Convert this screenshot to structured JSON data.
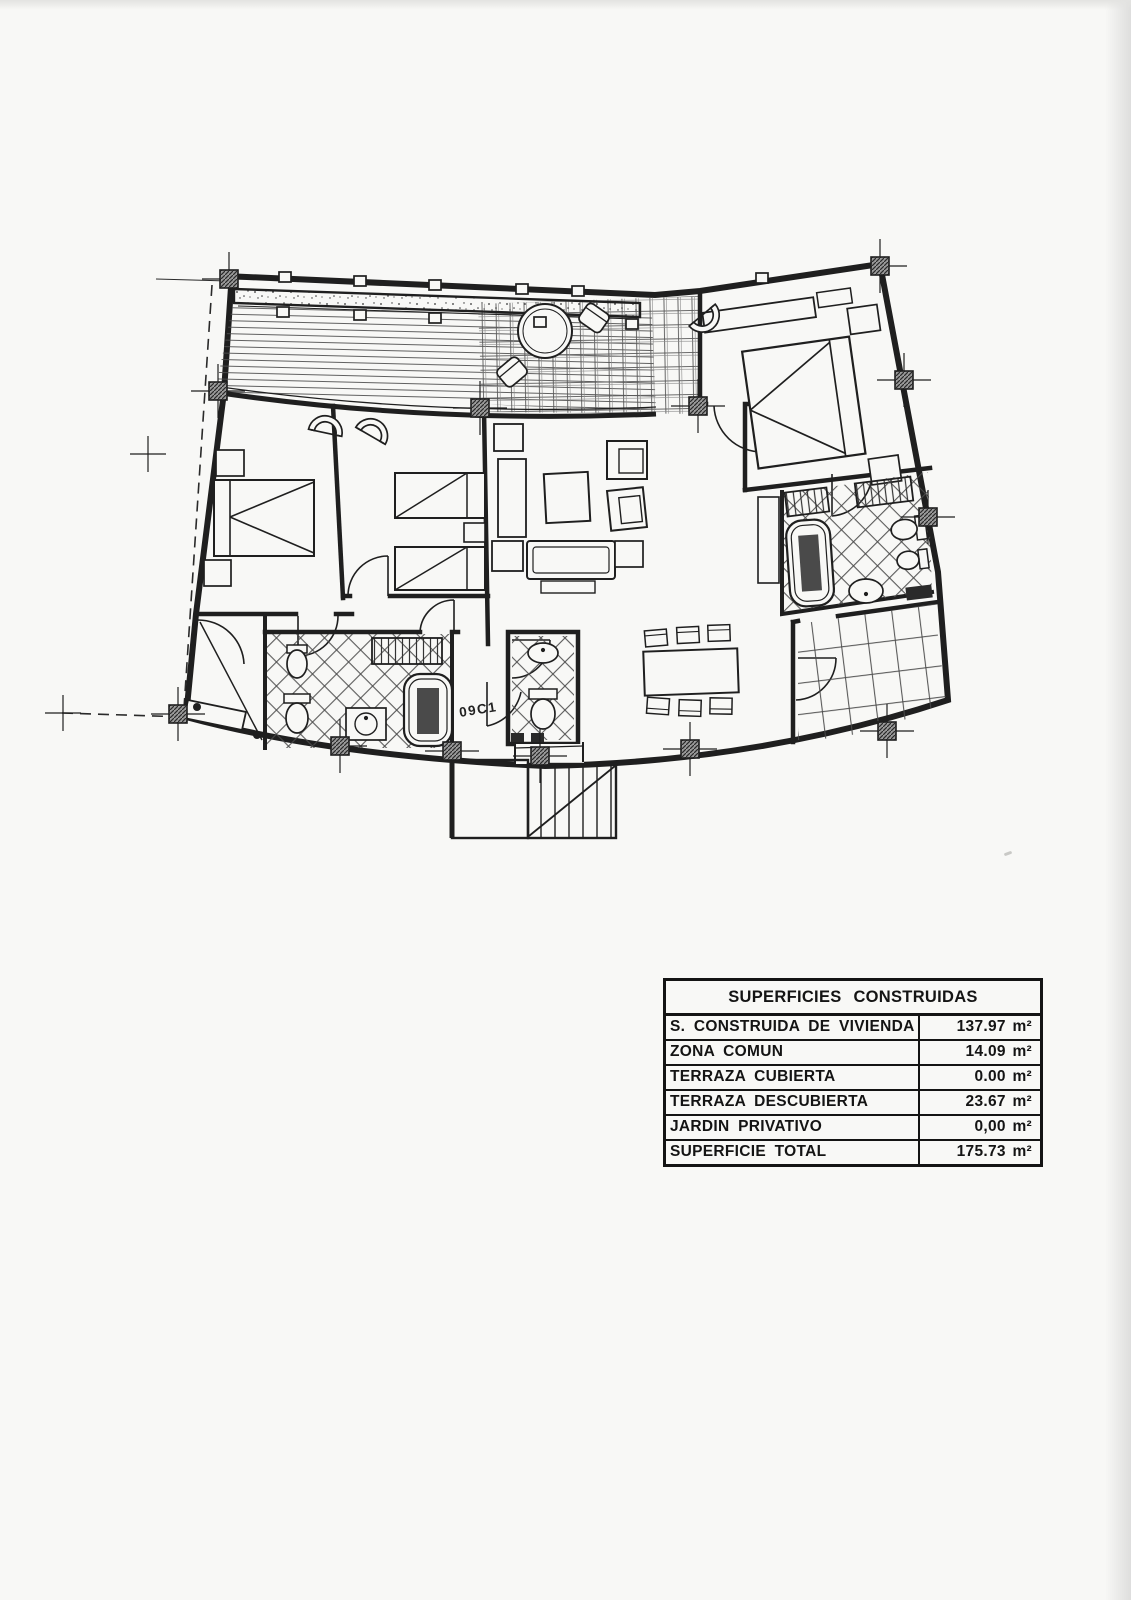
{
  "unit_label": "09C1",
  "areas_table": {
    "title": "SUPERFICIES CONSTRUIDAS",
    "rows": [
      {
        "label": "S. CONSTRUIDA DE VIVIENDA",
        "value": "137.97 m²"
      },
      {
        "label": "ZONA COMUN",
        "value": "14.09 m²"
      },
      {
        "label": "TERRAZA CUBIERTA",
        "value": "0.00 m²"
      },
      {
        "label": "TERRAZA DESCUBIERTA",
        "value": "23.67 m²"
      },
      {
        "label": "JARDIN PRIVATIVO",
        "value": "0,00 m²"
      },
      {
        "label": "SUPERFICIE TOTAL",
        "value": "175.73 m²"
      }
    ]
  },
  "colors": {
    "ink": "#1f1f1f",
    "paper": "#f8f8f6",
    "tile_line": "#4a4a4a",
    "pillar_fill": "#8f8f8f"
  },
  "icons": [
    "double-bed",
    "single-bed",
    "nightstand",
    "fan-armchair",
    "sofa",
    "coffee-table",
    "tv-cabinet",
    "dining-table",
    "dining-chair",
    "round-table",
    "terrace-chair",
    "bathtub",
    "toilet",
    "bidet",
    "sink",
    "wardrobe-shelf",
    "stairs",
    "door-arc",
    "pillar-marker",
    "survey-cross",
    "planter",
    "deck-boards",
    "pergola-grid"
  ]
}
